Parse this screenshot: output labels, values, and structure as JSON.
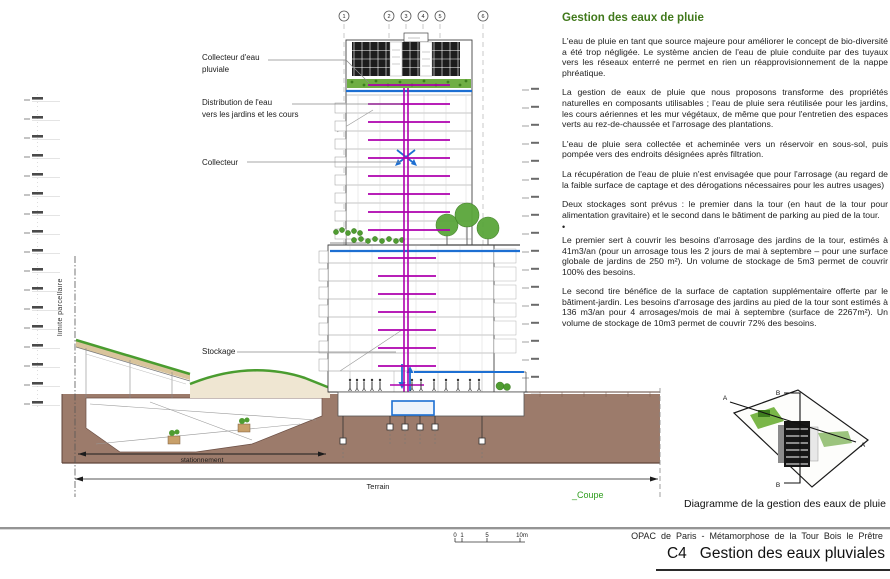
{
  "heading": {
    "title": "Gestion des eaux de pluie"
  },
  "paragraphs": [
    "L'eau de pluie en tant que source majeure pour améliorer le concept de bio-diversité a été trop négligée. Le système ancien de l'eau de pluie conduite par des tuyaux vers les réseaux enterré ne permet en rien un réapprovisionnement de la nappe phréatique.",
    "La gestion de eaux de pluie que nous proposons transforme des propriétés naturelles en composants utilisables ; l'eau de pluie sera réutilisée pour les jardins, les cours aériennes et les mur végétaux, de même que pour l'entretien des espaces verts au rez-de-chaussée et l'arrosage des plantations.",
    "L'eau de pluie sera collectée et acheminée vers un réservoir en sous-sol, puis pompée vers des endroits désignées après filtration.",
    "La récupération de l'eau de pluie n'est envisagée que pour l'arrosage (au regard de la faible surface de captage et des dérogations nécessaires pour les autres usages)",
    "Deux stockages sont prévus : le premier dans la tour (en haut de la tour pour alimentation gravitaire) et le second dans le bâtiment de parking au pied de la tour.",
    "•",
    "Le premier sert à couvrir les besoins d'arrosage des jardins de la tour, estimés à 41m3/an (pour un arrosage tous les 2 jours de mai à septembre – pour une surface globale de jardins de 250 m²). Un volume de stockage de 5m3 permet de couvrir 100% des besoins.",
    "Le second tire bénéfice de la surface de captation supplémentaire offerte par le bâtiment-jardin. Les besoins d'arrosage des jardins au pied de la tour sont estimés à 136 m3/an pour 4 arrosages/mois de mai à septembre (surface de 2267m²). Un volume de stockage de 10m3 permet de couvrir 72% des besoins."
  ],
  "annotations": {
    "collecteur_pluviale": [
      "Collecteur d'eau",
      "pluviale"
    ],
    "distribution": [
      "Distribution de l'eau",
      "vers les jardins et les cours"
    ],
    "collecteur": "Collecteur",
    "stockage": "Stockage",
    "limite_parcellaire": "limite parcellaire",
    "stationnement": "stationnement",
    "terrain": "Terrain",
    "coupe": "_Coupe"
  },
  "grid_bubbles": [
    "1",
    "2",
    "3",
    "4",
    "5",
    "6"
  ],
  "site_plan": {
    "caption": "Diagramme de la gestion des eaux de pluie",
    "markers": [
      "A",
      "B",
      "A",
      "B"
    ]
  },
  "footer": {
    "scale": [
      "0",
      "1",
      "5",
      "10m"
    ],
    "project": "OPAC de Paris - Métamorphose de la Tour Bois le Prêtre",
    "sheet_code": "C4",
    "sheet_title": "Gestion des eaux pluviales"
  },
  "colors": {
    "heading_green": "#41791c",
    "coupe_green": "#2f9e1e",
    "water_blue": "#1d6fd2",
    "pipe_magenta": "#ae00ae",
    "soil_brown": "#9c7b6b",
    "vegetation_green": "#4f9c31"
  }
}
